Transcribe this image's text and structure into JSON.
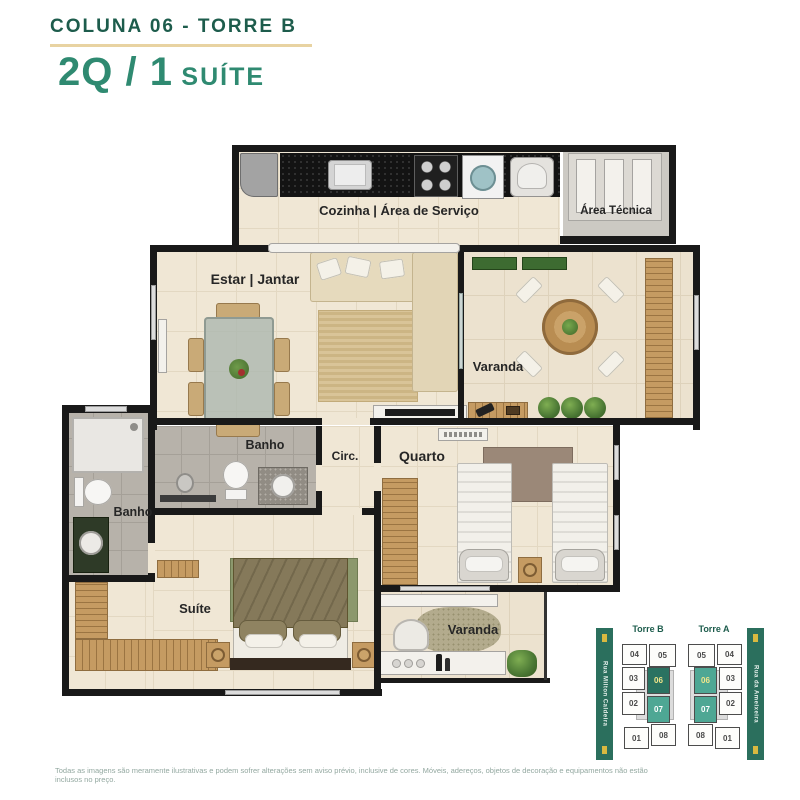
{
  "header": {
    "title": "COLUNA 06 - TORRE B",
    "subtitle_main": "2Q / 1",
    "subtitle_small": "SUÍTE"
  },
  "rooms": {
    "kitchen": "Cozinha | Área de Serviço",
    "technical_area": "Área Técnica",
    "living": "Estar | Jantar",
    "balcony": "Varanda",
    "suite_bathroom": "Banho",
    "social_bathroom": "Banho",
    "circulation": "Circ.",
    "bedroom": "Quarto",
    "suite": "Suíte",
    "suite_balcony": "Varanda"
  },
  "site_map": {
    "streets": {
      "left": "Rua Milton Caldeira",
      "right": "Rua da Ameixeira"
    },
    "towers": [
      {
        "name": "Torre B",
        "units": [
          {
            "label": "04",
            "state": "normal"
          },
          {
            "label": "05",
            "state": "normal"
          },
          {
            "label": "03",
            "state": "normal"
          },
          {
            "label": "06",
            "state": "selected"
          },
          {
            "label": "02",
            "state": "normal"
          },
          {
            "label": "07",
            "state": "sister"
          },
          {
            "label": "01",
            "state": "normal"
          },
          {
            "label": "08",
            "state": "normal"
          }
        ]
      },
      {
        "name": "Torre A",
        "units": [
          {
            "label": "05",
            "state": "normal"
          },
          {
            "label": "04",
            "state": "normal"
          },
          {
            "label": "06",
            "state": "sister-gold"
          },
          {
            "label": "03",
            "state": "normal"
          },
          {
            "label": "07",
            "state": "sister"
          },
          {
            "label": "02",
            "state": "normal"
          },
          {
            "label": "08",
            "state": "normal"
          },
          {
            "label": "01",
            "state": "normal"
          }
        ]
      }
    ],
    "colors": {
      "selected_unit": "#2a7261",
      "highlight_unit": "#4ea794",
      "street_bar": "#2b6f5d",
      "selected_text": "#f3e68a"
    }
  },
  "brand_colors": {
    "title": "#1d5c4c",
    "subtitle": "#2f8a71",
    "rule": "#e8d3a2"
  },
  "footer": {
    "disclaimer": "Todas as imagens são meramente ilustrativas e podem sofrer alterações sem aviso prévio, inclusive de cores. Móveis, adereços, objetos de decoração e equipamentos não estão inclusos no preço."
  }
}
